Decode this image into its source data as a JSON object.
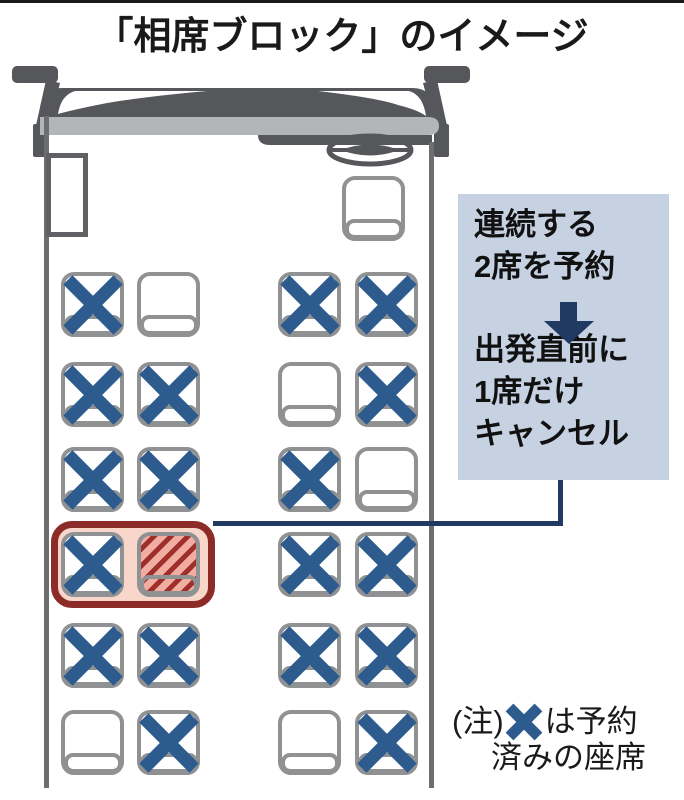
{
  "title": "「相席ブロック」のイメージ",
  "annotation_box": {
    "step1_line1": "連続する",
    "step1_line2": "2席を予約",
    "step2_line1": "出発直前に",
    "step2_line2": "1席だけ",
    "step2_line3": "キャンセル",
    "bg_color": "#c6d1e2",
    "arrow_color": "#203a64"
  },
  "note": {
    "prefix": "(注)",
    "text_after_icon": "は予約",
    "line2": "済みの座席"
  },
  "colors": {
    "reserved_x_blue": "#2d5b8d",
    "seat_border_gray": "#8f9193",
    "bus_dark_gray": "#56575a",
    "bus_light_gray": "#b4b5b7",
    "connector_navy": "#203a64",
    "highlight_border_red": "#8c2b28",
    "highlight_fill_pink": "#f8d6c9",
    "hatch_fill_pink": "#f2ada2",
    "hatch_stripe_red": "#9e2f2b"
  },
  "bus": {
    "seat_states_legend": {
      "reserved": "予約済み",
      "empty": "空席",
      "cancelled": "キャンセルされた席"
    },
    "seat_rows": [
      {
        "seats": [
          "reserved",
          "empty",
          "reserved",
          "reserved"
        ]
      },
      {
        "seats": [
          "reserved",
          "reserved",
          "empty",
          "reserved"
        ]
      },
      {
        "seats": [
          "reserved",
          "reserved",
          "reserved",
          "empty"
        ]
      },
      {
        "seats": [
          "reserved",
          "cancelled",
          "reserved",
          "reserved"
        ],
        "highlighted_pair": "left"
      },
      {
        "seats": [
          "reserved",
          "reserved",
          "reserved",
          "reserved"
        ]
      },
      {
        "seats": [
          "empty",
          "reserved",
          "empty",
          "reserved"
        ]
      }
    ]
  }
}
